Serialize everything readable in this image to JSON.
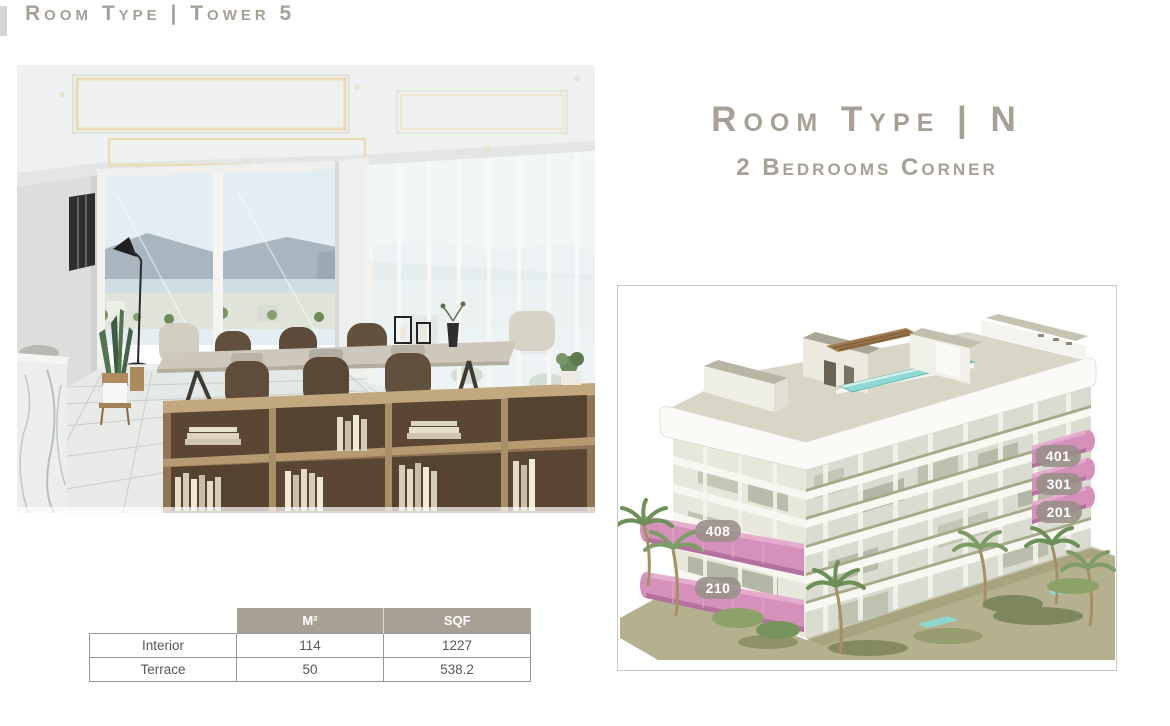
{
  "header": {
    "title": "Room Type | Tower 5"
  },
  "room": {
    "title": "Room Type | N",
    "subtitle": "2 Bedrooms Corner"
  },
  "area_table": {
    "corner_label": "",
    "columns": [
      "M²",
      "SQF"
    ],
    "rows": [
      {
        "label": "Interior",
        "m2": "114",
        "sqf": "1227"
      },
      {
        "label": "Terrace",
        "m2": "50",
        "sqf": "538.2"
      }
    ]
  },
  "building": {
    "units": [
      {
        "label": "401"
      },
      {
        "label": "301"
      },
      {
        "label": "201"
      },
      {
        "label": "408"
      },
      {
        "label": "210"
      }
    ],
    "highlight_color": "#d691ba",
    "badge_background": "#979086"
  },
  "colors": {
    "accent_taupe": "#a6a096",
    "table_header_background": "#a8a094",
    "rooftop_pool": "#8edad2"
  }
}
